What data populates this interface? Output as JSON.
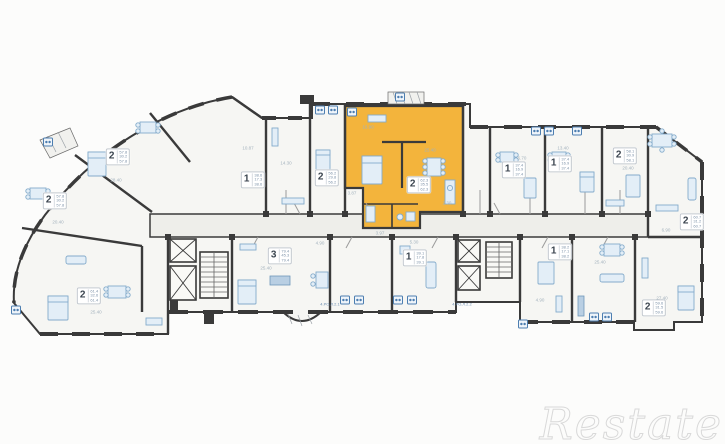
{
  "watermark": {
    "text": "Restate"
  },
  "plan": {
    "colors": {
      "wall": "#3a3a3a",
      "room_fill": "#f6f6f3",
      "corridor_fill": "#eeeeea",
      "highlight": "#f3b43c",
      "furniture_stroke": "#84abcb",
      "icon_blue": "#4d7eb0"
    },
    "highlight_unit": {
      "rooms": "2",
      "note": "highlighted apartment"
    },
    "unit_labels": [
      {
        "rooms": "2",
        "areas": [
          "57.8",
          "30.2",
          "57.8"
        ],
        "x": 118,
        "y": 157,
        "highlighted": false
      },
      {
        "rooms": "2",
        "areas": [
          "57.8",
          "30.2",
          "57.8"
        ],
        "x": 55,
        "y": 201,
        "highlighted": false
      },
      {
        "rooms": "2",
        "areas": [
          "61.4",
          "32.6",
          "61.4"
        ],
        "x": 89,
        "y": 296,
        "highlighted": false
      },
      {
        "rooms": "1",
        "areas": [
          "38.6",
          "17.3",
          "38.6"
        ],
        "x": 253,
        "y": 180,
        "highlighted": false
      },
      {
        "rooms": "2",
        "areas": [
          "56.2",
          "29.8",
          "56.2"
        ],
        "x": 327,
        "y": 178,
        "highlighted": false
      },
      {
        "rooms": "2",
        "areas": [
          "62.3",
          "35.5",
          "62.3"
        ],
        "x": 419,
        "y": 185,
        "highlighted": true
      },
      {
        "rooms": "1",
        "areas": [
          "37.4",
          "16.9",
          "37.4"
        ],
        "x": 514,
        "y": 170,
        "highlighted": false
      },
      {
        "rooms": "1",
        "areas": [
          "37.4",
          "16.9",
          "37.4"
        ],
        "x": 560,
        "y": 164,
        "highlighted": false
      },
      {
        "rooms": "2",
        "areas": [
          "58.1",
          "30.9",
          "58.1"
        ],
        "x": 625,
        "y": 156,
        "highlighted": false
      },
      {
        "rooms": "2",
        "areas": [
          "60.7",
          "31.2",
          "60.7"
        ],
        "x": 692,
        "y": 222,
        "highlighted": false
      },
      {
        "rooms": "3",
        "areas": [
          "79.4",
          "45.3",
          "79.4"
        ],
        "x": 280,
        "y": 256,
        "highlighted": false
      },
      {
        "rooms": "1",
        "areas": [
          "39.1",
          "17.8",
          "39.1"
        ],
        "x": 415,
        "y": 258,
        "highlighted": false
      },
      {
        "rooms": "1",
        "areas": [
          "38.2",
          "17.1",
          "38.2"
        ],
        "x": 560,
        "y": 252,
        "highlighted": false
      },
      {
        "rooms": "2",
        "areas": [
          "59.6",
          "31.5",
          "59.6"
        ],
        "x": 654,
        "y": 308,
        "highlighted": false
      }
    ],
    "dimensions": [
      {
        "t": "16.90",
        "x": 368,
        "y": 127
      },
      {
        "t": "25.40",
        "x": 430,
        "y": 150
      },
      {
        "t": "3.87",
        "x": 352,
        "y": 193
      },
      {
        "t": "2.30",
        "x": 447,
        "y": 203
      },
      {
        "t": "3.97",
        "x": 380,
        "y": 233
      },
      {
        "t": "14.30",
        "x": 286,
        "y": 163
      },
      {
        "t": "10.87",
        "x": 248,
        "y": 148
      },
      {
        "t": "6.70",
        "x": 522,
        "y": 158
      },
      {
        "t": "13.40",
        "x": 563,
        "y": 148
      },
      {
        "t": "20.40",
        "x": 628,
        "y": 168
      },
      {
        "t": "6.90",
        "x": 666,
        "y": 230
      },
      {
        "t": "25.40",
        "x": 600,
        "y": 262
      },
      {
        "t": "25.40",
        "x": 266,
        "y": 268
      },
      {
        "t": "5.30",
        "x": 414,
        "y": 242
      },
      {
        "t": "28.40",
        "x": 116,
        "y": 180
      },
      {
        "t": "20.40",
        "x": 58,
        "y": 222
      },
      {
        "t": "25.40",
        "x": 96,
        "y": 312
      },
      {
        "t": "4.90",
        "x": 540,
        "y": 300
      },
      {
        "t": "27.40",
        "x": 662,
        "y": 298
      },
      {
        "t": "4.90",
        "x": 320,
        "y": 243
      }
    ],
    "codes": [
      {
        "t": "4.РО.Л.2.1",
        "x": 330,
        "y": 304
      },
      {
        "t": "4.РО.Л.2.2",
        "x": 462,
        "y": 304
      }
    ],
    "icons": [
      {
        "x": 320,
        "y": 110
      },
      {
        "x": 333,
        "y": 110
      },
      {
        "x": 352,
        "y": 112
      },
      {
        "x": 400,
        "y": 97
      },
      {
        "x": 536,
        "y": 131
      },
      {
        "x": 549,
        "y": 131
      },
      {
        "x": 577,
        "y": 131
      },
      {
        "x": 345,
        "y": 300
      },
      {
        "x": 359,
        "y": 300
      },
      {
        "x": 398,
        "y": 300
      },
      {
        "x": 412,
        "y": 300
      },
      {
        "x": 594,
        "y": 317
      },
      {
        "x": 607,
        "y": 317
      },
      {
        "x": 523,
        "y": 324
      },
      {
        "x": 16,
        "y": 310
      },
      {
        "x": 48,
        "y": 142
      }
    ]
  }
}
